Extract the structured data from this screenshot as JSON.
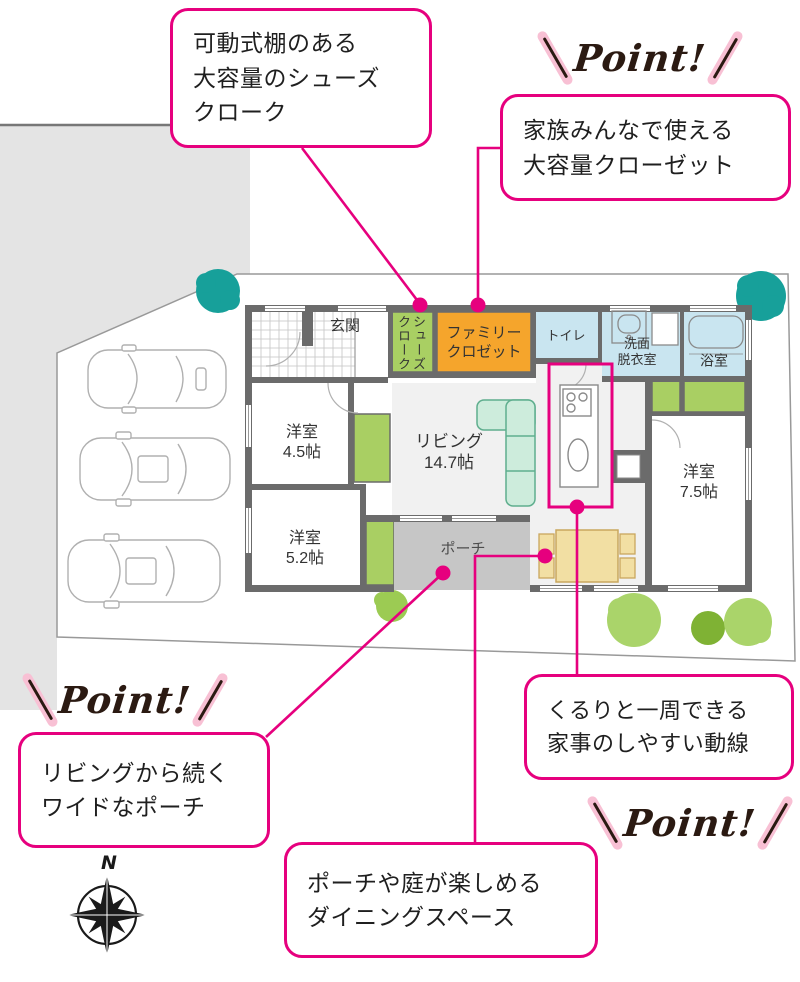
{
  "point_label": "Point!",
  "callouts": {
    "shoes": "可動式棚のある\n大容量のシューズ\nクローク",
    "family_closet": "家族みんなで使える\n大容量クローゼット",
    "porch": "リビングから続く\nワイドなポーチ",
    "dining": "ポーチや庭が楽しめる\nダイニングスペース",
    "flow": "くるりと一周できる\n家事のしやすい動線"
  },
  "floor_plan": {
    "rooms": {
      "genkan": "玄関",
      "shoes_closet": "シューズクローク",
      "family_closet": "ファミリー\nクロゼット",
      "toilet": "トイレ",
      "washroom": "洗面\n脱衣室",
      "bath": "浴室",
      "room_4_5": "洋室\n4.5帖",
      "room_5_2": "洋室\n5.2帖",
      "living": "リビング\n14.7帖",
      "room_7_5": "洋室\n7.5帖",
      "porch": "ポーチ"
    },
    "compass_north": "N"
  },
  "colors": {
    "accent_pink": "#e6007e",
    "slash_pink": "#f8c0d4",
    "wall_gray": "#6b6b6b",
    "closet_green": "#a9cf63",
    "family_closet_orange": "#f5a52c",
    "wet_area_blue": "#c9e5f0",
    "porch_gray": "#c6c6c6",
    "sofa_mint": "#cdecdc",
    "table_tan": "#f2dfa3",
    "tree_teal": "#17a09a",
    "tree_green": "#aad46a",
    "tree_dark_green": "#7fb234",
    "neighbor_gray": "#e4e4e4"
  }
}
